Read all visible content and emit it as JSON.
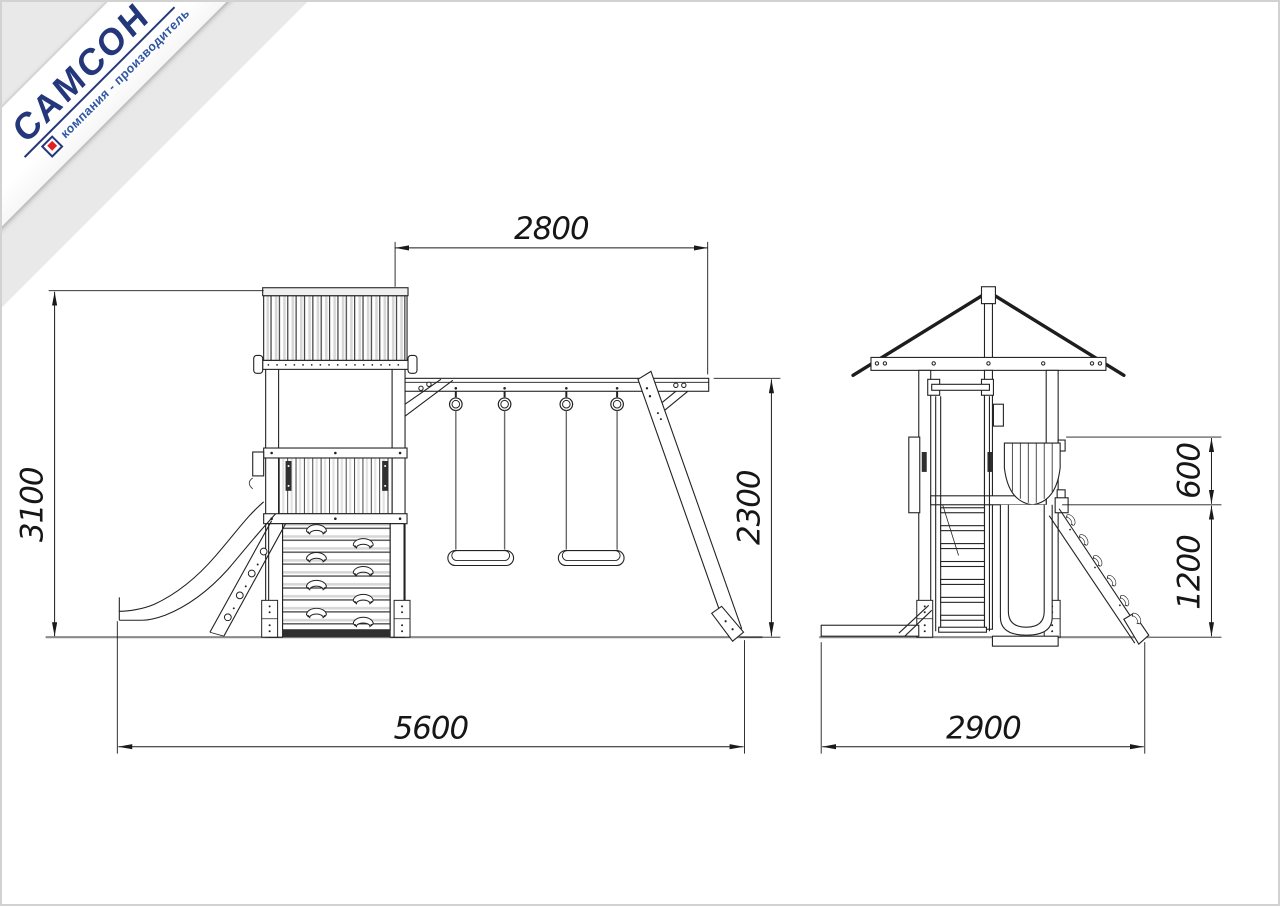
{
  "logo": {
    "brand": "САМСОН",
    "tagline": "компания - производитель",
    "brand_color": "#24377b",
    "tagline_color": "#2f55a4",
    "accent_red": "#e31e24"
  },
  "views": {
    "front": {
      "label": "front-elevation",
      "dims": {
        "beam_span": "2800",
        "total_height": "3100",
        "swing_height": "2300",
        "total_width": "5600"
      }
    },
    "side": {
      "label": "side-elevation",
      "dims": {
        "upper_offset": "600",
        "deck_height": "1200",
        "total_depth": "2900"
      }
    }
  }
}
